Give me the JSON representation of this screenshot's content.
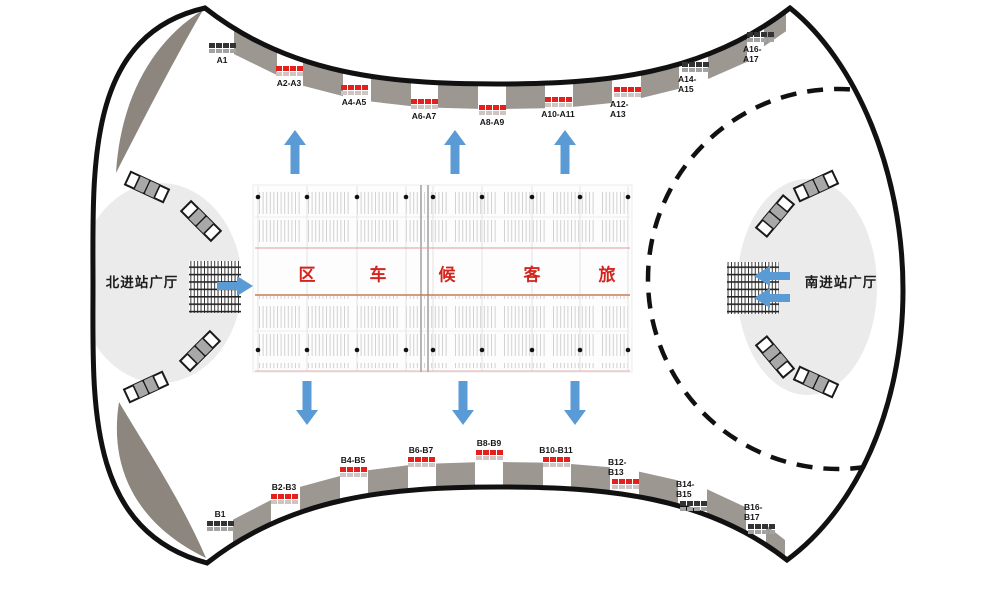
{
  "halls": {
    "north_label": "北进站广厅",
    "south_label": "南进站广厅"
  },
  "waiting_area_characters": [
    "区",
    "车",
    "候",
    "客",
    "旅"
  ],
  "gates_top": [
    {
      "label": "A1",
      "color": "dark"
    },
    {
      "label": "A2-A3",
      "color": "red"
    },
    {
      "label": "A4-A5",
      "color": "red"
    },
    {
      "label": "A6-A7",
      "color": "red"
    },
    {
      "label": "A8-A9",
      "color": "red"
    },
    {
      "label": "A10-A11",
      "color": "red"
    },
    {
      "label": "A12-A13",
      "color": "red"
    },
    {
      "label": "A14-A15",
      "color": "dark"
    },
    {
      "label": "A16-A17",
      "color": "dark"
    }
  ],
  "gates_bottom": [
    {
      "label": "B1",
      "color": "dark"
    },
    {
      "label": "B2-B3",
      "color": "red"
    },
    {
      "label": "B4-B5",
      "color": "red"
    },
    {
      "label": "B6-B7",
      "color": "red"
    },
    {
      "label": "B8-B9",
      "color": "red"
    },
    {
      "label": "B10-B11",
      "color": "red"
    },
    {
      "label": "B12-B13",
      "color": "red"
    },
    {
      "label": "B14-B15",
      "color": "dark"
    },
    {
      "label": "B16-B17",
      "color": "dark"
    }
  ],
  "colors": {
    "gate_red": "#e3201b",
    "gate_dark": "#333333",
    "gate_shadow_red": "#cfc4c1",
    "gate_shadow_dark": "#a3a3a3",
    "canopy": "#9d9791",
    "corner_blob": "#8d867f",
    "hall_fill": "#ebebeb",
    "outline": "#111111",
    "arrow_blue": "#5b9bd5",
    "waiting_text_red": "#d3251d",
    "floor_red_line": "#e09a94",
    "floor_center_line": "#c87b4e",
    "seat_tick": "#d2d2d2"
  }
}
